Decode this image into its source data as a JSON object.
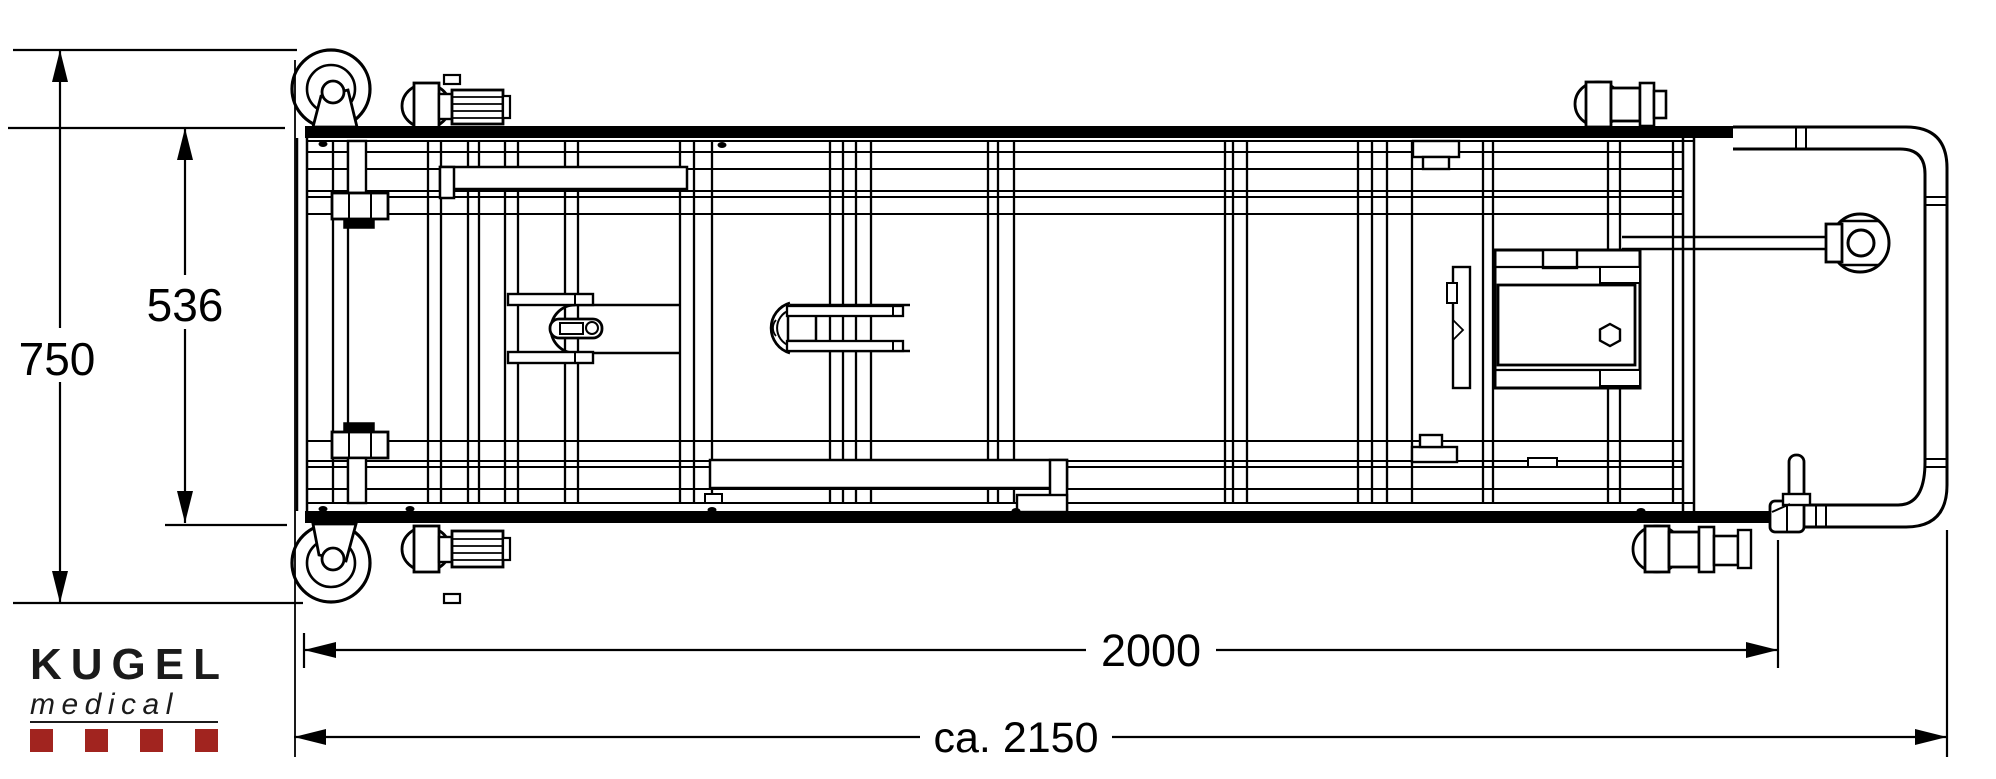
{
  "page": {
    "background_color": "#FFFFFF",
    "line_color": "#000000"
  },
  "dimensions": {
    "overall_width": {
      "label": "750"
    },
    "inner_width": {
      "label": "536"
    },
    "frame_length": {
      "label": "2000"
    },
    "overall_length": {
      "label": "ca. 2150"
    }
  },
  "logo": {
    "brand": "KUGEL",
    "division": "medical",
    "text_color": "#1B1B1B",
    "accent_color": "#A1241F",
    "square_count": 4
  }
}
